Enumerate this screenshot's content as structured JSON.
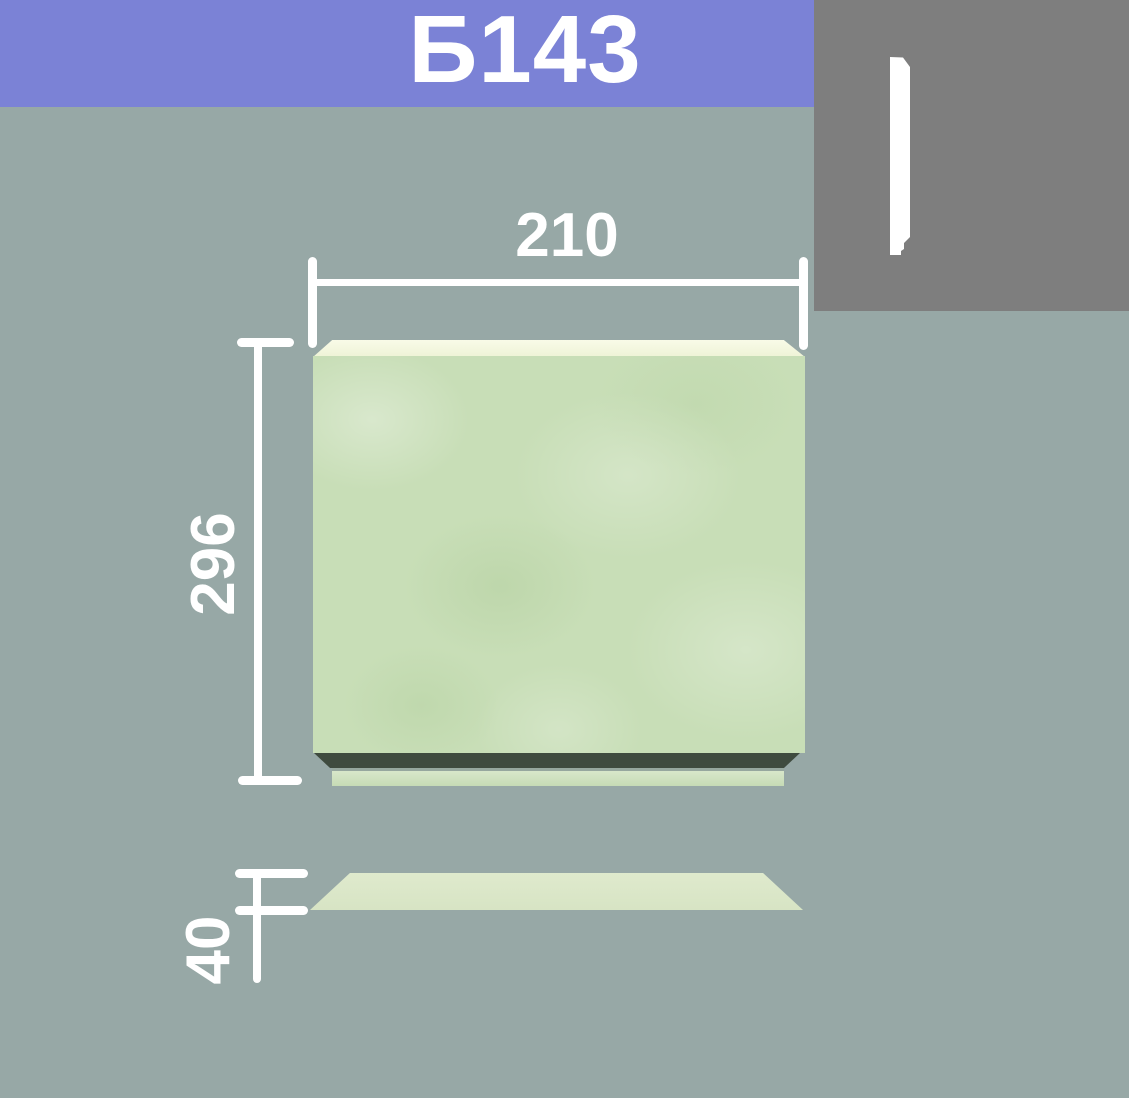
{
  "header": {
    "product_code": "Б143"
  },
  "drawing": {
    "front_view": {
      "width_dim": "210",
      "height_dim": "296"
    },
    "top_view": {
      "thickness_dim": "40"
    }
  },
  "values": {
    "width": 210,
    "height": 296,
    "thickness": 40
  },
  "colors": {
    "banner": "#7b82d6",
    "background": "#97a8a6",
    "corner_box": "#7e7e7e",
    "panel_face": "#c8deb7",
    "panel_top": "#f6f8e0",
    "panel_shadow": "#3f4b3f",
    "panel_foot": "#c6dbb5",
    "top_view": "#dfeacd",
    "dimension": "#ffffff",
    "profile_icon": "#ffffff"
  }
}
